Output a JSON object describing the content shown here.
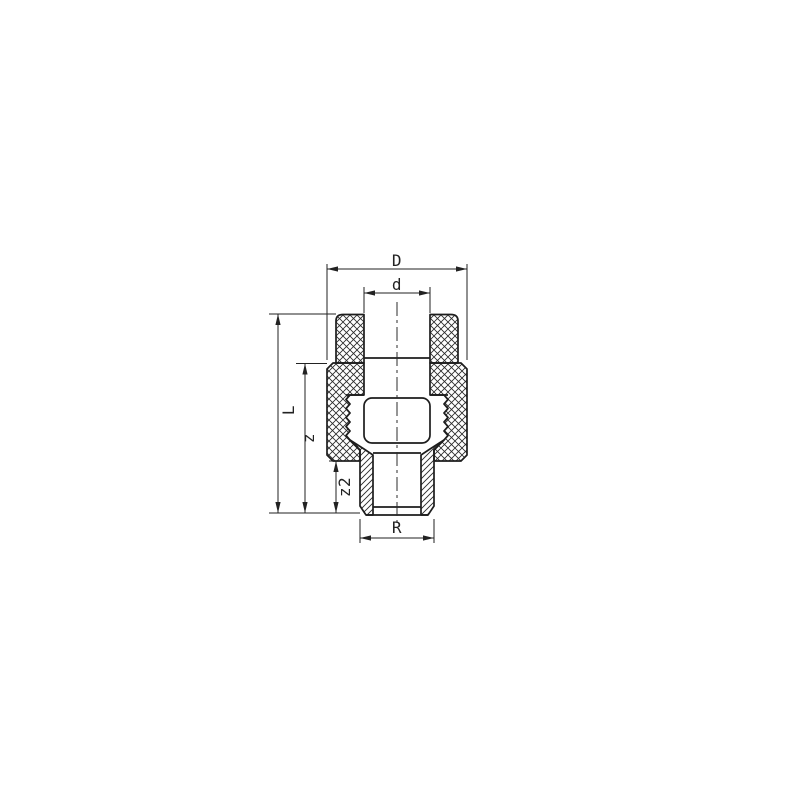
{
  "drawing": {
    "kind": "pipe-fitting-section-drawing",
    "labels": {
      "outer_diameter": "D",
      "socket_diameter": "d",
      "overall_length": "L",
      "body_length": "z",
      "thread_length": "z2",
      "thread_size": "R"
    },
    "colors": {
      "background": "#ffffff",
      "line": "#1d1d1d",
      "dimension": "#222222",
      "hatch": "#2b2b2b"
    }
  }
}
